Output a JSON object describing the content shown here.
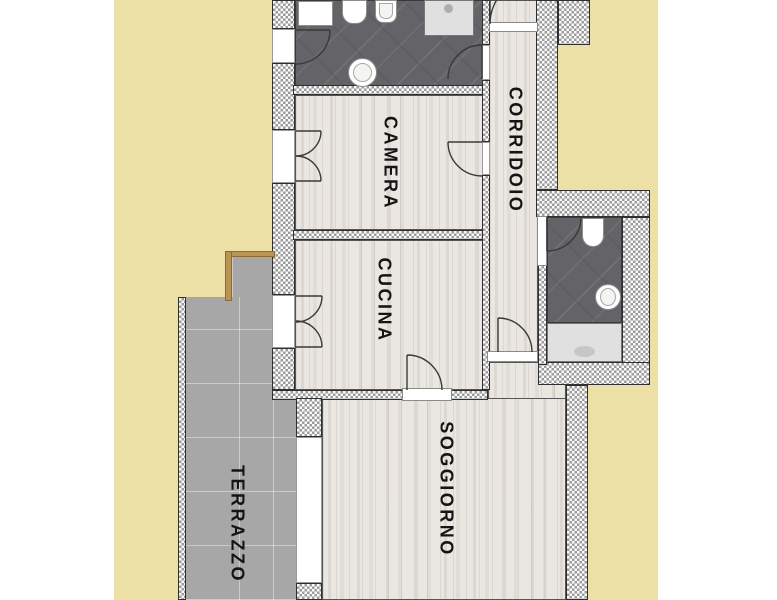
{
  "plan": {
    "title": "apartment floor plan",
    "rooms": [
      {
        "name": "camera",
        "label": "CAMERA"
      },
      {
        "name": "corridoio",
        "label": "CORRIDOIO"
      },
      {
        "name": "cucina",
        "label": "CUCINA"
      },
      {
        "name": "soggiorno",
        "label": "SOGGIORNO"
      },
      {
        "name": "terrazzo",
        "label": "TERRAZZO"
      }
    ],
    "unlabeled_rooms": [
      "bathroom-top",
      "bathroom-right"
    ],
    "fixtures": [
      "vanity",
      "toilet",
      "bathtub",
      "washbasin",
      "shower",
      "toilet",
      "washbasin",
      "shower-tray"
    ],
    "colors": {
      "background": "#ece0a6",
      "wall_outline": "#2f2f2f",
      "wood": "#eae7e2",
      "dark_floor": "#646468",
      "terrace": "#a7a7a7",
      "tan_edge": "#b99455",
      "label": "#141414"
    }
  }
}
